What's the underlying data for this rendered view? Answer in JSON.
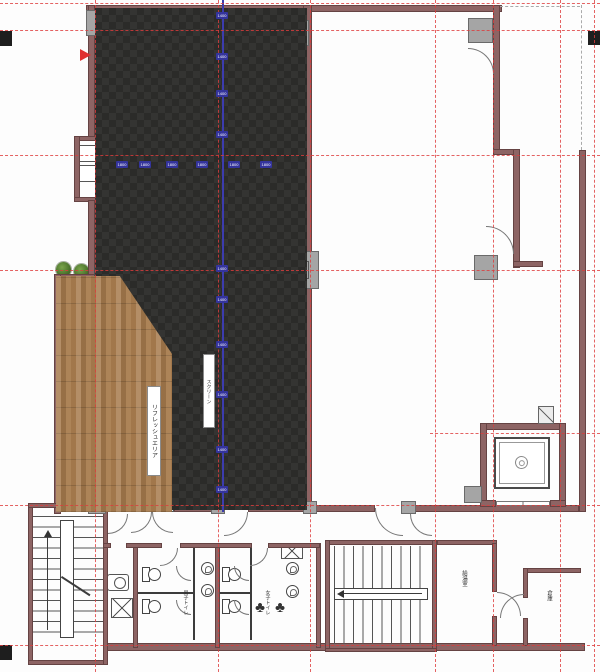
{
  "plan_type": "office-floor-plan",
  "labels": {
    "refresh_area": "リフレッシュエリア",
    "screen": "スクリーン",
    "mens_toilet": "男子トイレ",
    "womens_toilet": "女子トイレ",
    "kitchenette": "給湯室",
    "storage": "倉庫"
  },
  "dimensions": {
    "vertical_chip_values": [
      "1400",
      "1400",
      "1400",
      "1400",
      "1400",
      "1400",
      "1400",
      "1400",
      "1400",
      "1400"
    ],
    "horizontal_chip_values": [
      "1800",
      "1800",
      "1800",
      "1800",
      "1800",
      "1800"
    ]
  },
  "colors": {
    "wall": "#8d6464",
    "carpet": "#2b2b29",
    "carpet_alt": "#343432",
    "wood": "#a87c4e",
    "grid_red": "#de3c3c",
    "dimension_blue": "#34349c",
    "plant_green": "#48712a",
    "accent_orange": "#d8905f",
    "teal": "#52b9a5",
    "marker_red": "#e03030",
    "column_gray": "#a5a5a5"
  },
  "icons": {
    "entrance-arrow": "red-triangle",
    "plant-icon": "green-circle",
    "tree-icon": "♣",
    "toilet-icon": "tank-and-bowl",
    "urinal-icon": "circle-swirl",
    "sink-icon": "circle-in-rect",
    "elevator-car-icon": "double-square",
    "stairs-icon": "parallel-lines"
  }
}
